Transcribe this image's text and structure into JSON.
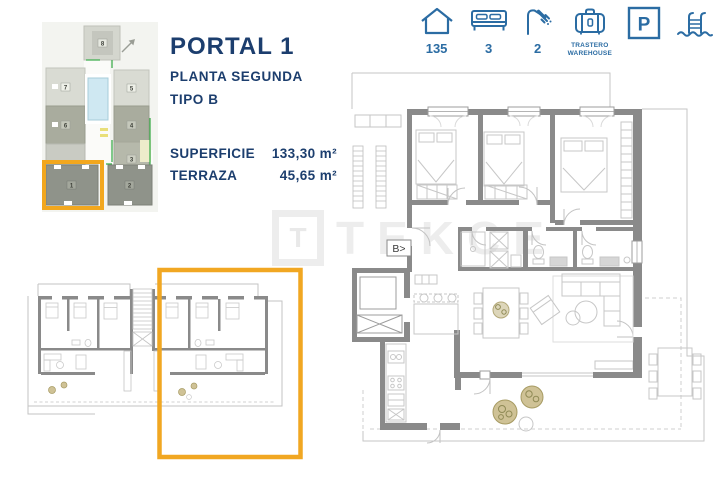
{
  "header": {
    "portal": "PORTAL 1",
    "planta": "PLANTA SEGUNDA",
    "tipo": "TIPO B",
    "superficie_label": "SUPERFICIE",
    "superficie_value": "133,30 m²",
    "terraza_label": "TERRAZA",
    "terraza_value": "45,65 m²"
  },
  "amenities": {
    "house_value": "135",
    "bed_value": "3",
    "shower_value": "2",
    "storage_label_line1": "TRASTERO",
    "storage_label_line2": "WAREHOUSE",
    "parking_letter": "P"
  },
  "site_plan": {
    "b1": "1",
    "b2": "2",
    "b3": "3",
    "b4": "4",
    "b5": "5",
    "b6": "6",
    "b7": "7",
    "b8": "8"
  },
  "main_plan": {
    "entry_label": "B>"
  },
  "watermark": {
    "logo_letter": "T",
    "text": "TEKCE"
  },
  "colors": {
    "navy": "#1c3e6e",
    "icon_blue": "#2b6ca3",
    "highlight_orange": "#f2a71e",
    "wall_gray": "#8a8a8a"
  }
}
